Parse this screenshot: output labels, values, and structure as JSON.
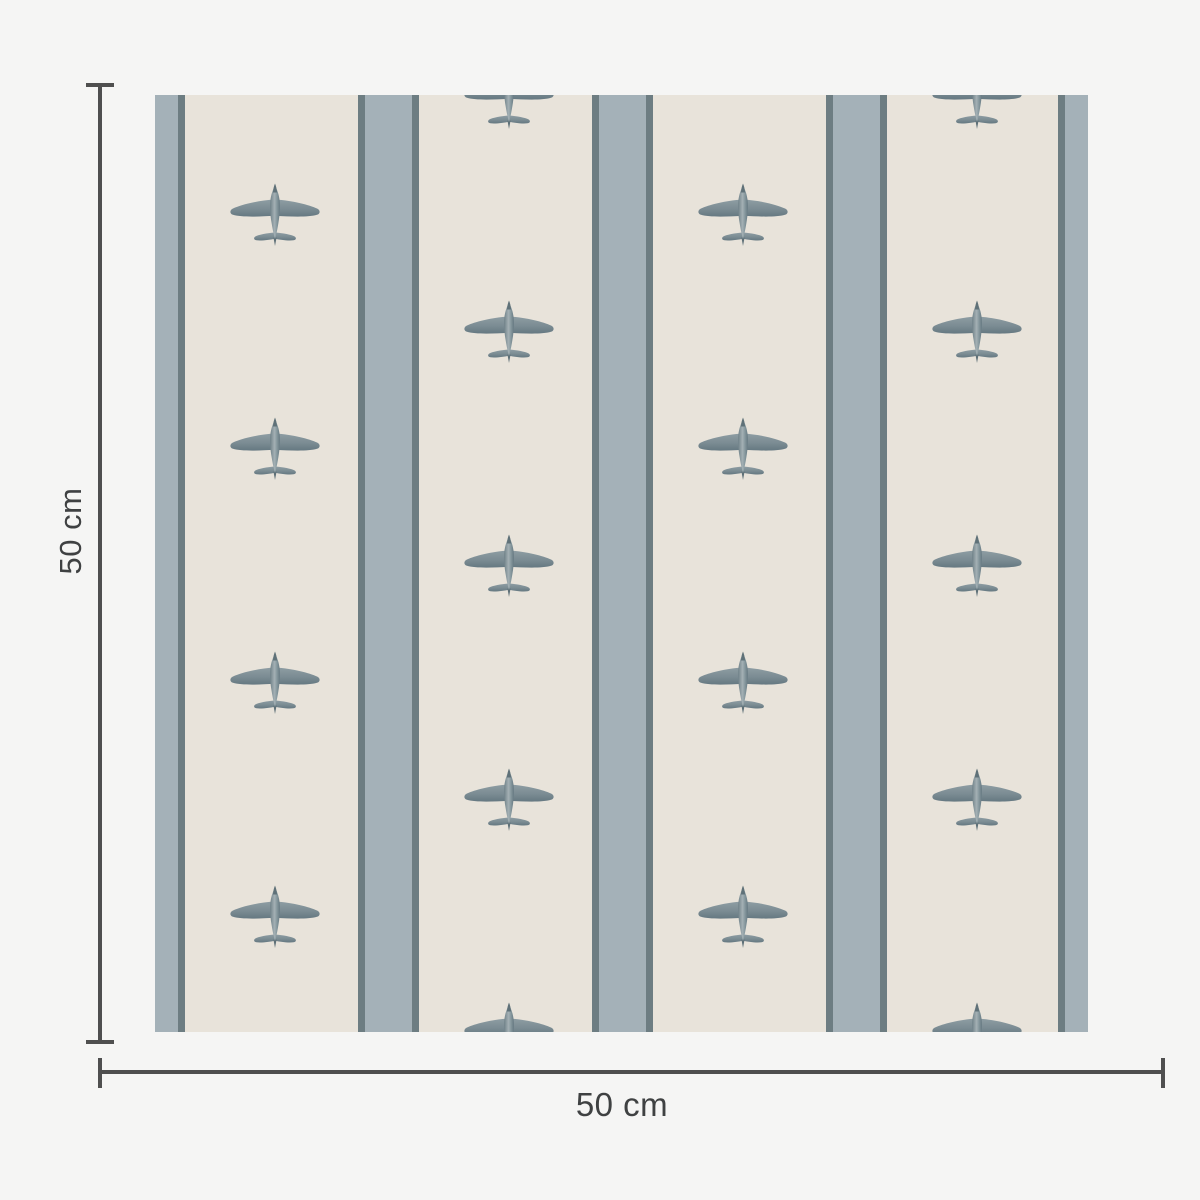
{
  "colors": {
    "background": "#f5f5f4",
    "cream": "#e8e3da",
    "stripe_light": "#a4b1b8",
    "stripe_dark": "#6d7d82",
    "dimension": "#4f4f4f",
    "text": "#3f4142",
    "plane_main": "#7e8f95",
    "plane_dark": "#63757c",
    "plane_light": "#a4b0b4"
  },
  "dimensions": {
    "height_label": "50 cm",
    "width_label": "50 cm"
  },
  "pattern": {
    "motif": "vintage-airplane-top-view",
    "plane_w": 96,
    "plane_h": 64,
    "stripes": [
      {
        "x": 0,
        "w": 23,
        "tone": "light"
      },
      {
        "x": 23,
        "w": 7,
        "tone": "dark"
      },
      {
        "x": 203,
        "w": 7,
        "tone": "dark"
      },
      {
        "x": 210,
        "w": 47,
        "tone": "light"
      },
      {
        "x": 257,
        "w": 7,
        "tone": "dark"
      },
      {
        "x": 437,
        "w": 7,
        "tone": "dark"
      },
      {
        "x": 444,
        "w": 47,
        "tone": "light"
      },
      {
        "x": 491,
        "w": 7,
        "tone": "dark"
      },
      {
        "x": 671,
        "w": 7,
        "tone": "dark"
      },
      {
        "x": 678,
        "w": 47,
        "tone": "light"
      },
      {
        "x": 725,
        "w": 7,
        "tone": "dark"
      },
      {
        "x": 903,
        "w": 7,
        "tone": "dark"
      },
      {
        "x": 910,
        "w": 23,
        "tone": "light"
      }
    ],
    "plane_columns": [
      {
        "x": 120,
        "ys": [
          120,
          354,
          588,
          822
        ]
      },
      {
        "x": 354,
        "ys": [
          3,
          237,
          471,
          705,
          939
        ]
      },
      {
        "x": 588,
        "ys": [
          120,
          354,
          588,
          822
        ]
      },
      {
        "x": 822,
        "ys": [
          3,
          237,
          471,
          705,
          939
        ]
      }
    ]
  }
}
